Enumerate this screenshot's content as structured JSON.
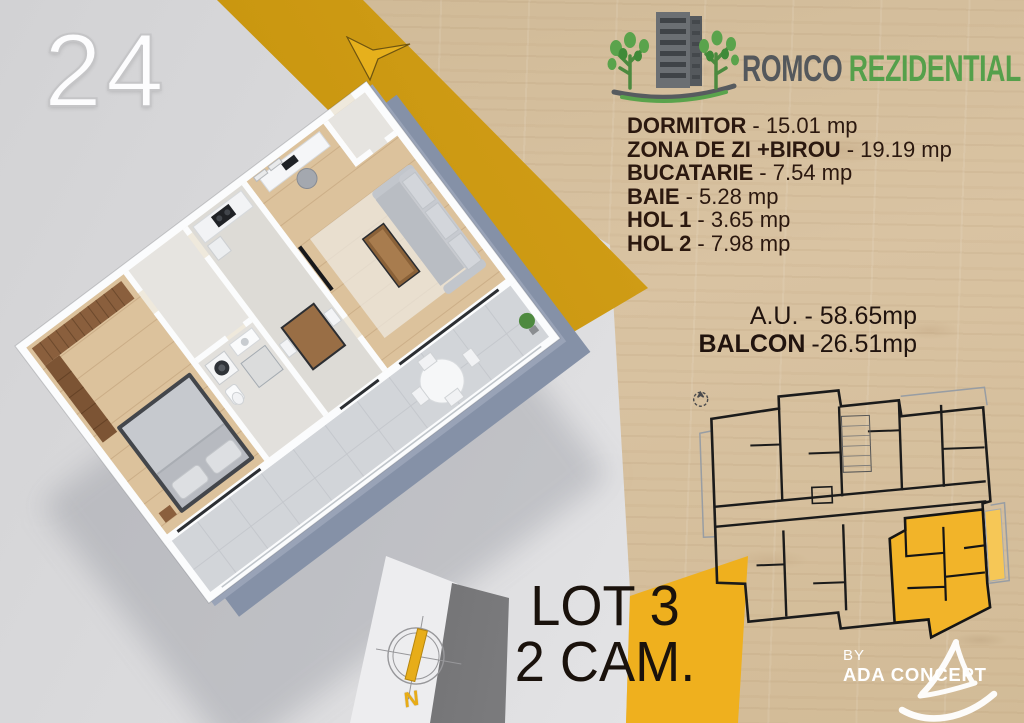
{
  "unit_badge": "24",
  "brand": {
    "primary": "ROMCO",
    "secondary": "REZIDENTIAL"
  },
  "rooms": [
    {
      "name": "DORMITOR",
      "area": "- 15.01 mp"
    },
    {
      "name": "ZONA DE ZI +BIROU",
      "area": "- 19.19 mp"
    },
    {
      "name": "BUCATARIE",
      "area": "- 7.54 mp"
    },
    {
      "name": "BAIE",
      "area": "- 5.28 mp"
    },
    {
      "name": "HOL 1",
      "area": "- 3.65 mp"
    },
    {
      "name": "HOL 2",
      "area": "- 7.98 mp"
    }
  ],
  "totals": {
    "au_label": "A.U.",
    "au_value": "- 58.65mp",
    "balcony_label": "BALCON",
    "balcony_value": "-26.51mp"
  },
  "lot": {
    "line1": "LOT 3",
    "line2": "2 CAM."
  },
  "credit": {
    "by": "BY",
    "studio": "ADA CONCEPT"
  },
  "compass": {
    "north_label": "N"
  },
  "icons": {
    "brand_logo": "building-with-trees-icon",
    "direction_arrow": "down-left-arrow-icon",
    "compass": "compass-icon",
    "mini_compass": "mini-compass-icon",
    "studio_logo": "brush-sail-icon"
  },
  "colors": {
    "accent_yellow_band": "#c9960f",
    "accent_yellow_bright": "#efb01e",
    "highlight_unit": "#f2b429",
    "brand_gray": "#54585c",
    "brand_green": "#55a04b"
  }
}
